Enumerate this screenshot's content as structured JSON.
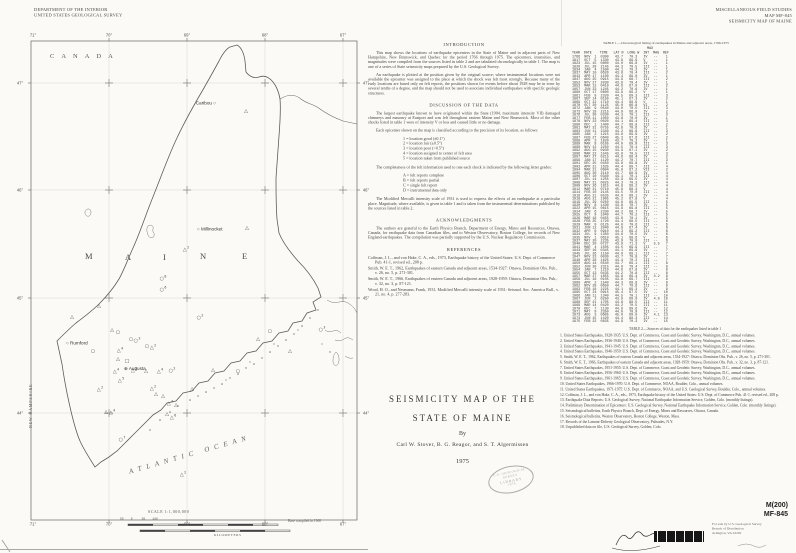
{
  "colors": {
    "paper": "#fbfaf6",
    "ink": "#3c3c3c",
    "linework": "#6b6b6b"
  },
  "header_left": {
    "line1": "DEPARTMENT OF THE INTERIOR",
    "line2": "UNITED STATES GEOLOGICAL SURVEY"
  },
  "header_right": {
    "line1": "MISCELLANEOUS FIELD STUDIES",
    "line2": "MAP MF-845",
    "line3": "SEISMICITY MAP OF MAINE"
  },
  "map": {
    "canada": "CANADA",
    "ocean": "ATLANTIC OCEAN",
    "new_hampshire": "NEW HAMPSHIRE",
    "maine_letters": [
      [
        "M",
        85,
        251
      ],
      [
        "A",
        125,
        252
      ],
      [
        "I",
        163,
        252
      ],
      [
        "N",
        200,
        251
      ],
      [
        "E",
        242,
        251
      ]
    ],
    "grid_labels": [
      {
        "t": "71°",
        "x": 33,
        "y": 35
      },
      {
        "t": "70°",
        "x": 109,
        "y": 35
      },
      {
        "t": "69°",
        "x": 187,
        "y": 35
      },
      {
        "t": "68°",
        "x": 265,
        "y": 35
      },
      {
        "t": "67°",
        "x": 343,
        "y": 35
      },
      {
        "t": "71°",
        "x": 33,
        "y": 524
      },
      {
        "t": "70°",
        "x": 109,
        "y": 524
      },
      {
        "t": "69°",
        "x": 187,
        "y": 524
      },
      {
        "t": "68°",
        "x": 265,
        "y": 524
      },
      {
        "t": "67°",
        "x": 343,
        "y": 524
      },
      {
        "t": "47°",
        "x": 20,
        "y": 83
      },
      {
        "t": "46°",
        "x": 20,
        "y": 190
      },
      {
        "t": "45°",
        "x": 20,
        "y": 298
      },
      {
        "t": "44°",
        "x": 20,
        "y": 413
      },
      {
        "t": "47°",
        "x": 366,
        "y": 83
      },
      {
        "t": "46°",
        "x": 366,
        "y": 190
      },
      {
        "t": "45°",
        "x": 366,
        "y": 298
      },
      {
        "t": "44°",
        "x": 366,
        "y": 413
      }
    ],
    "towns": [
      {
        "name": "Caribou",
        "x": 216,
        "y": 103,
        "sym": "○",
        "side": "left"
      },
      {
        "name": "Millinocket",
        "x": 197,
        "y": 229,
        "sym": "○",
        "side": "right"
      },
      {
        "name": "Rumford",
        "x": 66,
        "y": 343,
        "sym": "○",
        "side": "right"
      },
      {
        "name": "Augusta",
        "x": 124,
        "y": 369,
        "sym": "⊕",
        "side": "right"
      }
    ],
    "epicenters": [
      [
        72,
        318,
        "t",
        ""
      ],
      [
        99,
        307,
        "t",
        ""
      ],
      [
        200,
        318,
        "c",
        "2"
      ],
      [
        112,
        331,
        "t",
        ""
      ],
      [
        118,
        333,
        "c",
        ""
      ],
      [
        131,
        340,
        "c",
        ""
      ],
      [
        137,
        341,
        "c",
        "3"
      ],
      [
        120,
        351,
        "t",
        "4"
      ],
      [
        147,
        347,
        "c",
        ""
      ],
      [
        153,
        348,
        "t",
        "2"
      ],
      [
        118,
        360,
        "t",
        ""
      ],
      [
        127,
        362,
        "q",
        ""
      ],
      [
        116,
        372,
        "t",
        "4"
      ],
      [
        134,
        371,
        "t",
        "2"
      ],
      [
        146,
        372,
        "t",
        ""
      ],
      [
        160,
        372,
        "t",
        "4"
      ],
      [
        172,
        371,
        "c",
        "2"
      ],
      [
        121,
        381,
        "t",
        "5"
      ],
      [
        100,
        390,
        "t",
        "2"
      ],
      [
        93,
        352,
        "c",
        ""
      ],
      [
        186,
        250,
        "t",
        "2"
      ],
      [
        163,
        279,
        "c",
        "8"
      ],
      [
        163,
        290,
        "c",
        "6"
      ],
      [
        247,
        229,
        "t",
        ""
      ],
      [
        246,
        112,
        "t",
        ""
      ],
      [
        156,
        395,
        "t",
        ""
      ],
      [
        163,
        397,
        "t",
        ""
      ],
      [
        170,
        404,
        "t",
        "4"
      ],
      [
        176,
        406,
        "t",
        ""
      ],
      [
        167,
        415,
        "t",
        ""
      ],
      [
        173,
        418,
        "t",
        "6"
      ],
      [
        106,
        413,
        "t",
        ""
      ],
      [
        112,
        413,
        "t",
        "4"
      ],
      [
        122,
        440,
        "c",
        "7"
      ],
      [
        183,
        475,
        "t",
        "2"
      ],
      [
        213,
        371,
        "t",
        ""
      ],
      [
        238,
        372,
        "c",
        ""
      ],
      [
        192,
        390,
        "t",
        ""
      ],
      [
        153,
        389,
        "t",
        "2"
      ],
      [
        322,
        330,
        "c",
        "3"
      ],
      [
        290,
        352,
        "t",
        ""
      ],
      [
        258,
        340,
        "t",
        ""
      ],
      [
        270,
        332,
        "c",
        ""
      ]
    ],
    "scale": {
      "label": "SCALE 1:1,000,000",
      "ticks_row": "50    0     50    100",
      "units": "KILOMETERS",
      "base_note": "Base compiled in 1968"
    }
  },
  "intro": {
    "heading": "INTRODUCTION",
    "p1": "This map shows the locations of earthquake epicenters in the State of Maine and in adjacent parts of New Hampshire, New Brunswick, and Quebec for the period 1766 through 1975. The epicenters, intensities, and magnitudes were compiled from the sources listed in table 2 and are tabulated chronologically in table 1. The map is one of a series of State seismicity maps prepared by the U.S. Geological Survey.",
    "p2": "An earthquake is plotted at the position given by the original source; where instrumental locations were not available the epicenter was assigned to the place at which the shock was felt most strongly. Because many of the early locations are based only on felt reports, the positions shown for events before about 1928 may be in error by several tenths of a degree, and the map should not be used to associate individual earthquakes with specific geologic structures."
  },
  "discussion": {
    "heading": "DISCUSSION OF THE DATA",
    "p1": "The largest earthquake known to have originated within the State (1904, maximum intensity VII) damaged chimneys and masonry at Eastport and was felt throughout eastern Maine and New Brunswick. Most of the other shocks listed in table 1 were of intensity V or less and caused little or no damage.",
    "p2": "Each epicenter shown on the map is classified according to the precision of its location, as follows:",
    "list1": [
      "1 = location good (±0.1°)",
      "2 = location fair (±0.5°)",
      "3 = location poor (>0.5°)",
      "4 = location assigned to center of felt area",
      "5 = location taken from published source"
    ],
    "p3": "The completeness of the felt information used to rate each shock is indicated by the following letter grades:",
    "list2": [
      "A = felt reports complete",
      "B = felt reports partial",
      "C = single felt report",
      "D = instrumental data only"
    ],
    "p4": "The Modified Mercalli intensity scale of 1931 is used to express the effects of an earthquake at a particular place. Magnitude, where available, is given in table 1 and is taken from the instrumental determinations published by the sources listed in table 2."
  },
  "acknowledgments": {
    "heading": "ACKNOWLEDGMENTS",
    "p": "The authors are grateful to the Earth Physics Branch, Department of Energy, Mines and Resources, Ottawa, Canada, for earthquake data from Canadian files, and to Weston Observatory, Boston College, for records of New England earthquakes. The compilation was partially supported by the U.S. Nuclear Regulatory Commission."
  },
  "references": {
    "heading": "REFERENCES",
    "items": [
      "Coffman, J. L., and von Hake, C. A., eds., 1973, Earthquake history of the United States: U.S. Dept. of Commerce Pub. 41-1, revised ed., 208 p.",
      "Smith, W. E. T., 1962, Earthquakes of eastern Canada and adjacent areas, 1534-1927: Ottawa, Dominion Obs. Pub., v. 26, no. 5, p. 271-301.",
      "Smith, W. E. T., 1966, Earthquakes of eastern Canada and adjacent areas, 1928-1959: Ottawa, Dominion Obs. Pub., v. 32, no. 3, p. 87-121.",
      "Wood, H. O., and Neumann, Frank, 1931, Modified Mercalli intensity scale of 1931: Seismol. Soc. America Bull., v. 21, no. 4, p. 277-283."
    ]
  },
  "title_block": {
    "line1": "SEISMICITY MAP OF THE",
    "line2": "STATE OF MAINE",
    "by": "By",
    "authors": "Carl W. Stover, B. G. Reagor, and S. T. Algermissen",
    "year": "1975"
  },
  "stamp": {
    "line1": "U.S. GEOLOGICAL SURVEY",
    "line2": "LIBRARY",
    "line3": "1976"
  },
  "table1": {
    "title": "TABLE 1.—Chronological listing of earthquakes in Maine and adjacent areas, 1766-1975",
    "head1": "                                      MAX",
    "head2": "YEAR  DATE    TIME   LAT N  LONG W  INT  MAG  REF",
    "rows": [
      "1766  NOV  1  0300   43.7   70.3   IV   --    1",
      "1817  OCT  5  1330   43.9   69.9   V    --    1",
      "1823  JUL 15  0800   44.0   69.8   IV   --    1",
      "1829  JUL 29  2145   44.3   70.5   III  --    1",
      "1834  JAN  4  1500   44.1   70.2   IV   --    1",
      "1837  MAY 10  0620   43.8   70.4   III  --    2",
      "1843  APR 17  1100   44.4   69.0   IV   --    1",
      "1847  AUG 25  0915   44.9   68.7   III  --    2",
      "1852  NOV 27  2030   43.6   70.4   IV   --    1",
      "1853  MAR 12  0410   44.6   67.9   III  --    2",
      "1857  JUN 23  1245   44.2   70.6   IV   --    1",
      "1860  OCT 17  0600   43.9   69.2   V    --    1",
      "1861  FEB  8  2320   44.5   69.3   III  --    3",
      "1867  SEP 14  0150   45.1   67.3   IV   --    2",
      "1869  OCT 22  1710   44.4   68.9   V    --    1",
      "1870  OCT 20  1125   45.0   66.8   VI   --    2",
      "1872  JAN  9  0540   44.0   70.5   III  --    3",
      "1873  NOV 18  2215   44.9   66.9   IV   --    2",
      "1876  JUL 30  0330   44.3   70.1   III  --    3",
      "1877  FEB 11  1050   43.8   70.0   IV   --    1",
      "1878  NOV 23  0020   44.1   69.4   III  --    3",
      "1880  DEC  1  1400   44.7   68.8   III  --    2",
      "1881  MAY 31  0755   43.6   70.6   IV   --    1",
      "1883  JUN 11  2340   44.2   69.6   III  --    3",
      "1885  JAN  2  1215   44.8   69.9   IV   --    2",
      "1887  FEB 27  0640   45.3   67.6   III  --    2",
      "1888  APR  3  1820   43.7   70.2   IV   --    1",
      "1889  MAR  8  0105   44.0   69.9   III  --    3",
      "1890  NOV 12  2250   44.5   70.4   III  --    3",
      "1892  AUG 15  0930   44.9   67.1   IV   --    2",
      "1896  MAR 22  1545   43.9   70.5   III  --    3",
      "1897  MAY 27  0215   44.6   68.4   IV   --    2",
      "1899  JAN 17  1120   44.2   70.7   III  --    3",
      "1901  DEC 25  0450   43.8   69.8   IV   --    1",
      "1903  APR 21  1635   44.4   69.7   III  --    4",
      "1904  MAR 21  0604   45.0   67.2   VII  --    2",
      "1905  AUG 30  2110   44.7   68.9   IV   --    4",
      "1906  OCT 10  0340   44.1   70.1   III  --    4",
      "1907  JUL 14  1255   43.9   69.5   IV   --    4",
      "1908  MAY 31  0025   44.3   70.3   III  --    4",
      "1909  NOV 26  1815   44.8   68.2   IV   --    4",
      "1912  MAR 21  0710   45.9   68.4   V    --    4",
      "1914  FEB 10  2145   44.5   70.0   III  --    4",
      "1916  AUG 21  0535   44.0   69.1   IV   --    4",
      "1918  AUG 21  1905   45.2   67.8   V    --    4",
      "1919  JUL 29  0250   44.6   69.5   III  --    5",
      "1920  NOV  8  1430   43.8   70.7   IV   --    5",
      "1922  APR 15  0615   44.9   69.8   III  --    5",
      "1924  JAN  6  2330   44.2   68.7   IV   --    5",
      "1925  OCT  9  1040   44.7   70.2   III  --    5",
      "1926  MAR 18  0455   43.6   70.1   IV   --    5",
      "1928  FEB 25  1720   44.4   68.5   III  --    6",
      "1929  MAR  9  0125   44.0   70.6   III  --    6",
      "1931  JUN 12  2040   44.8   67.4   IV   --    6",
      "1932  APR  6  0910   44.3   69.2   III  --    6",
      "1934  JUL  9  1350   44.6   70.5   IV   --    6",
      "1935  NOV  1  0610   45.1   68.6   V    --    6",
      "1937  MAY 20  2235   43.9   70.0   III  --    6",
      "1940  DEC 20  0727   43.9   71.3   V    5.5   7",
      "1941  MAR  4  1505   44.5   69.9   III  --    7",
      "1943  SEP 16  0345   44.1   69.6   IV   --    7",
      "1945  JUL 26  1150   44.9   68.1   III  --    7",
      "1947  NOV 23  0030   43.7   70.8   IV   --    7",
      "1948  APR 28  1625   44.4   70.2   III  --    7",
      "1950  AUG 14  0540   44.7   69.1   III  --    8",
      "1952  JUN 30  2315   44.0   70.4   III  --    8",
      "1954  JAN  7  1210   44.6   67.8   IV   --    8",
      "1955  OCT 13  0435   44.2   70.8   III  --    8",
      "1957  MAR 27  1855   44.8   69.4   IV   4.2   8",
      "1958  JUL 16  0105   43.8   69.7   III  --    9",
      "1960  APR  2  1540   44.3   68.8   IV   --    9",
      "1962  NOV 28  0650   44.7   70.6   III  --    9",
      "1963  FEB 18  2225   44.1   69.3   IV   --    9",
      "1965  OCT 24  0915   45.4   67.5   IV   --   10",
      "1966  JAN 11  1340   44.5   70.1   III  --   10",
      "1967  JUN  2  0250   43.9   69.0   IV   4.0  10",
      "1968  SEP 21  1705   44.8   68.5   III  --   11",
      "1969  MAR 14  0420   44.2   70.5   III  --   11",
      "1970  DEC  7  1130   44.6   69.6   IV   --   12",
      "1971  MAY  9  2350   44.0   70.9   III  --   12",
      "1973  AUG  3  0605   45.0   69.0   IV   4.1  13",
      "1974  JUN 15  1420   44.4   68.3   III  --   14",
      "1975  FEB 22  0835   44.9   70.3   IV   --   15"
    ]
  },
  "table2": {
    "title": "TABLE 2.—Sources of data for the earthquakes listed in table 1",
    "entries": [
      "1.  United States Earthquakes, 1928-1935: U.S. Dept. of Commerce, Coast and Geodetic Survey, Washington, D.C., annual volumes.",
      "2.  United States Earthquakes, 1936-1940: U.S. Dept. of Commerce, Coast and Geodetic Survey, Washington, D.C., annual volumes.",
      "3.  United States Earthquakes, 1941-1945: U.S. Dept. of Commerce, Coast and Geodetic Survey, Washington, D.C., annual volumes.",
      "4.  United States Earthquakes, 1946-1950: U.S. Dept. of Commerce, Coast and Geodetic Survey, Washington, D.C., annual volumes.",
      "5.  Smith, W. E. T., 1962, Earthquakes of eastern Canada and adjacent areas, 1534-1927: Ottawa, Dominion Obs. Pub., v. 26, no. 5, p. 271-301.",
      "6.  Smith, W. E. T., 1966, Earthquakes of eastern Canada and adjacent areas, 1928-1959: Ottawa, Dominion Obs. Pub., v. 32, no. 3, p. 87-121.",
      "7.  United States Earthquakes, 1951-1955: U.S. Dept. of Commerce, Coast and Geodetic Survey, Washington, D.C., annual volumes.",
      "8.  United States Earthquakes, 1956-1960: U.S. Dept. of Commerce, Coast and Geodetic Survey, Washington, D.C., annual volumes.",
      "9.  United States Earthquakes, 1961-1965: U.S. Dept. of Commerce, Coast and Geodetic Survey, Washington, D.C., annual volumes.",
      "10. United States Earthquakes, 1966-1970: U.S. Dept. of Commerce, NOAA, Boulder, Colo., annual volumes.",
      "11. United States Earthquakes, 1971-1975: U.S. Dept. of Commerce, NOAA, and U.S. Geological Survey, Boulder, Colo., annual volumes.",
      "12. Coffman, J. L., and von Hake, C. A., eds., 1973, Earthquake history of the United States: U.S. Dept. of Commerce Pub. 41-1, revised ed., 208 p.",
      "13. Earthquake Data Reports: U.S. Geological Survey, National Earthquake Information Service, Golden, Colo. (monthly listings).",
      "14. Preliminary Determination of Epicenters: U.S. Geological Survey, National Earthquake Information Service, Golden, Colo. (monthly listings).",
      "15. Seismological bulletins, Earth Physics Branch, Dept. of Energy, Mines and Resources, Ottawa, Canada.",
      "16. Seismological bulletins, Weston Observatory, Boston College, Weston, Mass.",
      "17. Records of the Lamont-Doherty Geological Observatory, Palisades, N.Y.",
      "18. Unpublished data on file, U.S. Geological Survey, Golden, Colo."
    ]
  },
  "footer": {
    "code1": "M(200)",
    "code2": "MF-845",
    "side_note": [
      "For sale by U.S. Geological Survey",
      "Branch of Distribution",
      "Arlington, VA 22202"
    ]
  }
}
